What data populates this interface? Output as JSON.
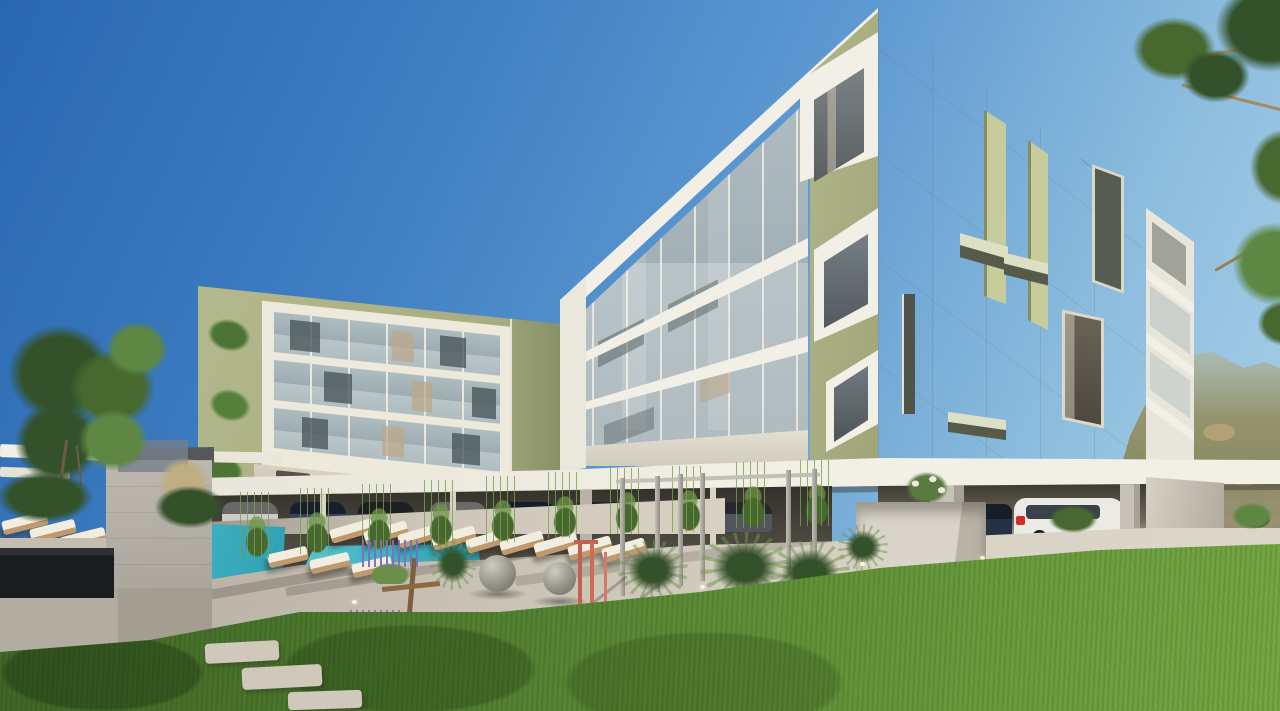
{
  "meta": {
    "type": "architectural-rendering",
    "description": "3D exterior rendering of a modern residential complex: two sage-green panelled apartment buildings with white concrete balcony frames and glass railings, a turquoise swimming pool lined with rows of white sun loungers, a board-formed concrete pool bar wall with white pergola beams, ornamental grasses, lavender, two decorative concrete spheres, a steel pergola frame, covered parking with cars (including a white SUV with red taillights), a bright green lawn in the foreground, trees at both edges, and a hazy mountain hillside in the background under a clear blue sky.",
    "visible_text": []
  },
  "canvas": {
    "width": 1280,
    "height": 711
  },
  "palette": {
    "sky-1": "#2a67b2",
    "sky-2": "#3f7fc2",
    "sky-3": "#5f9ad2",
    "sky-4": "#8ebede",
    "sky-5": "#aed4ec",
    "green-lit": "#c8ce9f",
    "green-mid": "#a8ae82",
    "green-shade": "#aab17f",
    "white-lit": "#f1efe6",
    "glass-1": "#b6c2c6",
    "glass-2": "#93a2a8",
    "concrete": "#aaa69c",
    "pave": "#d9d3c6",
    "pool-1": "#5cc6cf",
    "pool-2": "#2f9fb4",
    "grass-dark": "#3e6526",
    "grass-light": "#74a643",
    "leaf-dark": "#33522a",
    "leaf-mid": "#47682f",
    "leaf-light": "#5d8742",
    "tan": "#b3a176",
    "cushion": "#f1ede1",
    "wood": "#c09a6c",
    "coral": "#c4604e",
    "navy-car": "#27334d",
    "suv-white": "#eceae4",
    "taillight-red": "#cf2d26",
    "bar-counter": "#1b1c1e"
  },
  "scene": {
    "sky": "clear gradient blue, darkest upper-left",
    "background": [
      "mountain hillside with scrub trees (right)",
      "tree canopy overhanging (top-right)",
      "round tree (left edge)"
    ],
    "buildings": [
      {
        "name": "left-apartment-block",
        "floors_visible": 3,
        "facade": "sage green panels, white frame, glass balconies, hanging planters, ground-floor terraces over parking colonnade"
      },
      {
        "name": "right-apartment-block",
        "floors_visible": 4,
        "facade": "white-framed balcony face (left), sage green panel face with slot windows, fins and angled shades (right), white trim edge balconies"
      }
    ],
    "amenities": [
      "turquoise pool",
      "sun lounger rows",
      "concrete pool-bar wall with pergola",
      "dark stone bar counter",
      "steel pergola posts",
      "concrete sphere decorations",
      "timber sculpture",
      "coral outdoor shower",
      "lavender and grass planting",
      "in-ground spot lights",
      "stepping stones"
    ],
    "vehicles": [
      "row of cars under left building",
      "dark blue car in garage",
      "white SUV with red taillights",
      "concrete garage pillars"
    ]
  }
}
